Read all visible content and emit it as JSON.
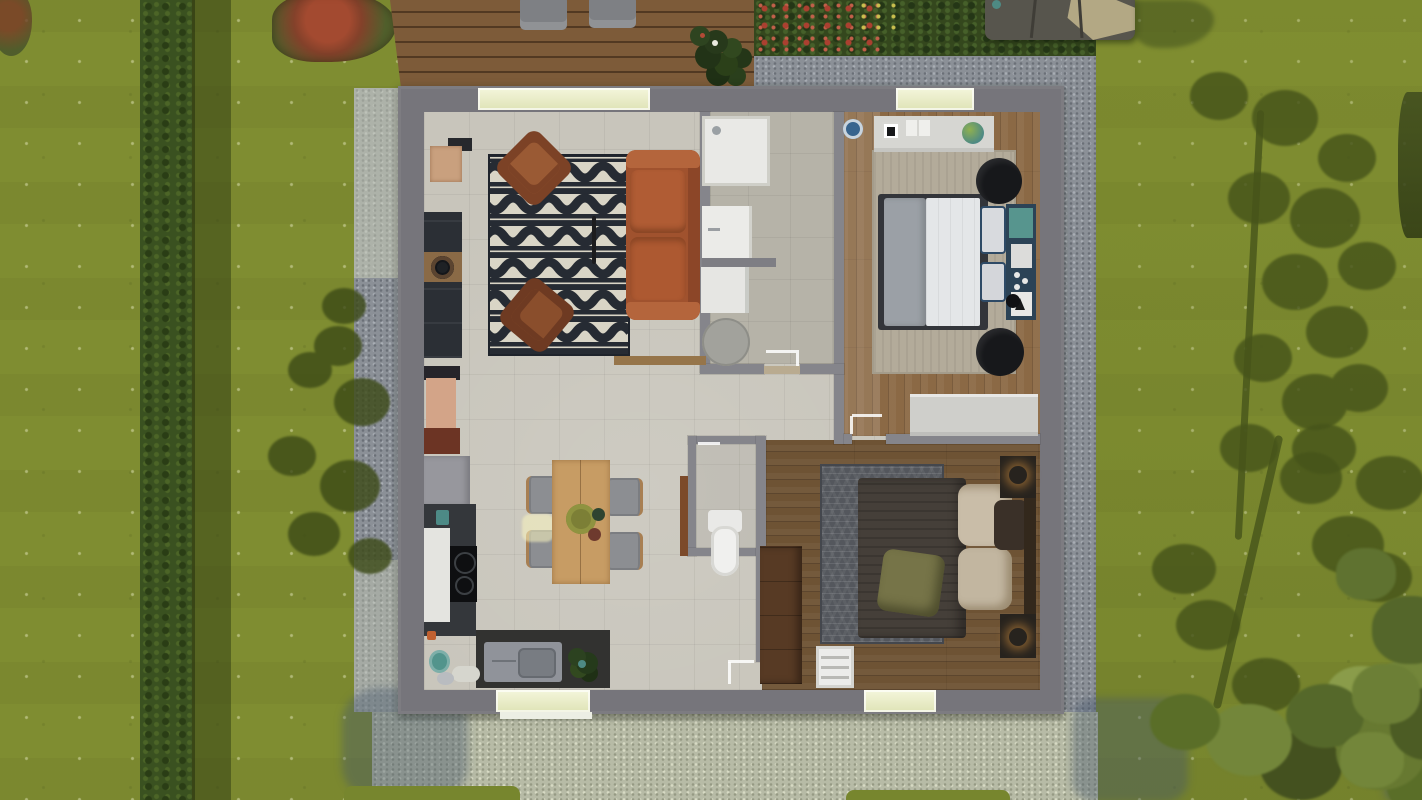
{
  "scene": {
    "description": "Top-down 3D architectural render of a small single-storey house floor plan set in a garden",
    "view": "top-down aerial",
    "style": "3D floor plan visualization, daytime lighting with tree shadows"
  },
  "palette": {
    "grass": "#7f8d31",
    "hedge": "#3a5120",
    "deck_wood": "#7d5b39",
    "gravel_border": "#8b9097",
    "terrace_gravel": "#b7bba6",
    "outer_wall": "#76757b",
    "partition_wall": "#85858b",
    "tile_floor": "#c8c5bb",
    "bathroom_tile": "#b6b3a8",
    "bedroom1_wood": "#8b6945",
    "bedroom2_wood": "#6e5334",
    "window_glass": "#e9ecca",
    "tree_shadow": "#46541a",
    "sofa": "#a0522e",
    "armchair": "#7c4226",
    "living_rug_base": "#262b33",
    "living_rug_pattern": "#d9d5c6",
    "bedroom2_rug": "#54575d",
    "bed1_duvet": "#e4e6e8",
    "bed1_blanket": "#9ba0a6",
    "bed2_duvet": "#453f39",
    "lamp_glow": "#ffb050",
    "accent_teal": "#57958e",
    "accent_navy": "#2c4356",
    "red_bush": "#a34a30",
    "gazebo_canvas_dark": "#57554d",
    "gazebo_canvas_beige": "#b3a884"
  },
  "garden": {
    "features": [
      {
        "name": "lawn",
        "type": "grass with small white flowers and mowing stripes"
      },
      {
        "name": "hedge-row",
        "type": "tall hedge running vertically on the left with cast shadow"
      },
      {
        "name": "red-bush",
        "type": "red-leaved shrub at top left"
      },
      {
        "name": "wood-deck",
        "type": "plank deck at top with two grey sun loungers and a potted plant"
      },
      {
        "name": "shrub-border",
        "type": "dark shrubs with red and yellow flowers along the top"
      },
      {
        "name": "shade-sail-gazebo",
        "type": "grey and beige shade canopy at top right"
      },
      {
        "name": "gravel-border",
        "type": "blue-grey gravel strip around the house"
      },
      {
        "name": "gravel-terrace",
        "type": "light gravel terrace below the house"
      },
      {
        "name": "tree-shadows",
        "type": "two large tree shadows on the right lawn and a conifer shadow on the left"
      },
      {
        "name": "tree-canopy",
        "type": "real tree foliage entering the bottom-right corner"
      }
    ]
  },
  "house": {
    "shape": "rectangular footprint with grey perimeter walls",
    "windows": [
      {
        "name": "living-room-window",
        "wall": "top"
      },
      {
        "name": "bedroom1-window",
        "wall": "top"
      },
      {
        "name": "kitchen-window",
        "wall": "bottom"
      },
      {
        "name": "bedroom2-window",
        "wall": "bottom"
      }
    ],
    "rooms": [
      {
        "name": "living-room",
        "floor": "beige tile",
        "furniture": [
          {
            "item": "tv-cabinet",
            "color": "#2b2f35"
          },
          {
            "item": "speaker",
            "color": "#1e2125"
          },
          {
            "item": "wall-shelf",
            "color": "#c9a07e"
          },
          {
            "item": "patterned-rug",
            "colors": [
              "#262b33",
              "#d9d5c6"
            ]
          },
          {
            "item": "armchair-1",
            "color": "#7c4226"
          },
          {
            "item": "armchair-2",
            "color": "#6e3a22"
          },
          {
            "item": "floor-lamp",
            "color": "#1c1c1e"
          },
          {
            "item": "sofa-terracotta",
            "color": "#a0522e"
          },
          {
            "item": "console-table",
            "colors": [
              "#d3a488",
              "#6c3424"
            ]
          }
        ]
      },
      {
        "name": "kitchen-dining",
        "floor": "beige tile",
        "furniture": [
          {
            "item": "tall-fridge-unit",
            "color": "#97979d"
          },
          {
            "item": "kitchen-counter-left",
            "colors": [
              "#34373b",
              "#e4e4e0"
            ]
          },
          {
            "item": "cooktop",
            "color": "#0e0f11"
          },
          {
            "item": "sink-counter-bottom",
            "colors": [
              "#323230",
              "#90939a"
            ]
          },
          {
            "item": "kettle",
            "color": "#52948c"
          },
          {
            "item": "potted-plant",
            "color": "#2c4220"
          },
          {
            "item": "dining-table",
            "color": "#c79c64"
          },
          {
            "item": "dining-chairs-x4",
            "color": "#8c8e92"
          },
          {
            "item": "round-placemat",
            "color": "#7c7f36"
          }
        ]
      },
      {
        "name": "bathroom",
        "floor": "grey-beige tile",
        "furniture": [
          {
            "item": "shower-tray",
            "color": "#e9e9e6"
          },
          {
            "item": "vanity-sink",
            "color": "#ebebe8"
          },
          {
            "item": "washing-machine",
            "color": "#e6e6e3"
          },
          {
            "item": "round-bath-rug",
            "color": "#a2a29c"
          }
        ]
      },
      {
        "name": "wc",
        "floor": "beige tile",
        "furniture": [
          {
            "item": "toilet",
            "color": "#f0f0ee"
          },
          {
            "item": "open-door-leaf",
            "color": "#7c4a2a"
          }
        ]
      },
      {
        "name": "bedroom-1-top-right",
        "floor": "oak wood",
        "furniture": [
          {
            "item": "dresser-with-decor",
            "color": "#d6d6d2"
          },
          {
            "item": "area-rug",
            "color": "#b3ab9a"
          },
          {
            "item": "double-bed-white-grey",
            "colors": [
              "#e4e6e8",
              "#9ba0a6"
            ]
          },
          {
            "item": "navy-headboard-shelf",
            "colors": [
              "#2c4356",
              "#57958e"
            ]
          },
          {
            "item": "black-poufs-x2",
            "color": "#17181b"
          },
          {
            "item": "low-sideboard",
            "color": "#cfcfcb"
          },
          {
            "item": "blue-round-mat",
            "color": "#38648e"
          },
          {
            "item": "plant-ball",
            "color": "#5e8f46"
          }
        ]
      },
      {
        "name": "bedroom-2-bottom-right",
        "floor": "dark oak wood",
        "furniture": [
          {
            "item": "wardrobe",
            "color": "#573a24"
          },
          {
            "item": "chevron-rug",
            "color": "#54575d"
          },
          {
            "item": "double-bed-dark-duvet",
            "color": "#453f39"
          },
          {
            "item": "olive-pillow",
            "color": "#767448"
          },
          {
            "item": "beige-pillows",
            "color": "#c9bda8"
          },
          {
            "item": "nightstands-with-lit-lamps-x2",
            "colors": [
              "#27231e",
              "#ffb050"
            ]
          },
          {
            "item": "white-ladder-rack",
            "color": "#ececea"
          }
        ]
      }
    ]
  }
}
